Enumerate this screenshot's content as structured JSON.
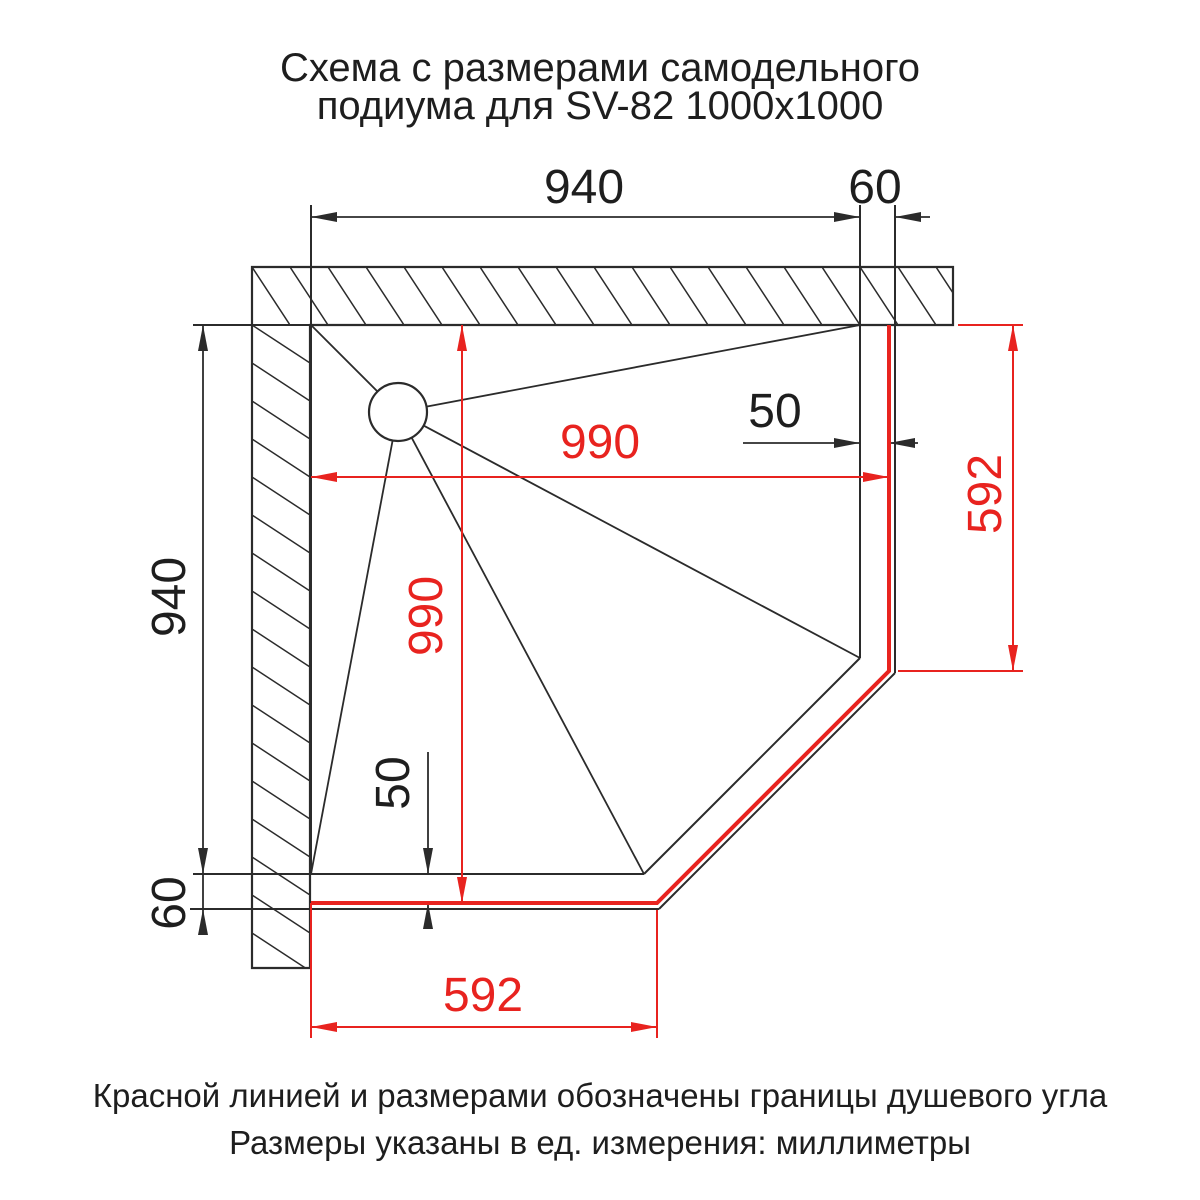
{
  "title": {
    "line1": "Схема с размерами самодельного",
    "line2": "подиума для SV-82 1000x1000"
  },
  "dimensions": {
    "tray_width_top": "940",
    "podium_overhang_top": "60",
    "glass_offset_right": "50",
    "shower_zone_width": "990",
    "shower_zone_depth": "990",
    "tray_depth_left": "940",
    "podium_overhang_bottom": "60",
    "glass_offset_bottom": "50",
    "front_edge_right": "592",
    "front_edge_bottom": "592"
  },
  "notes": {
    "line1": "Красной линией и размерами обозначены границы душевого угла",
    "line2": "Размеры указаны в ед. измерения: миллиметры"
  },
  "colors": {
    "boundary_red": "#e8231f",
    "drawing_black": "#2b2b2b"
  }
}
